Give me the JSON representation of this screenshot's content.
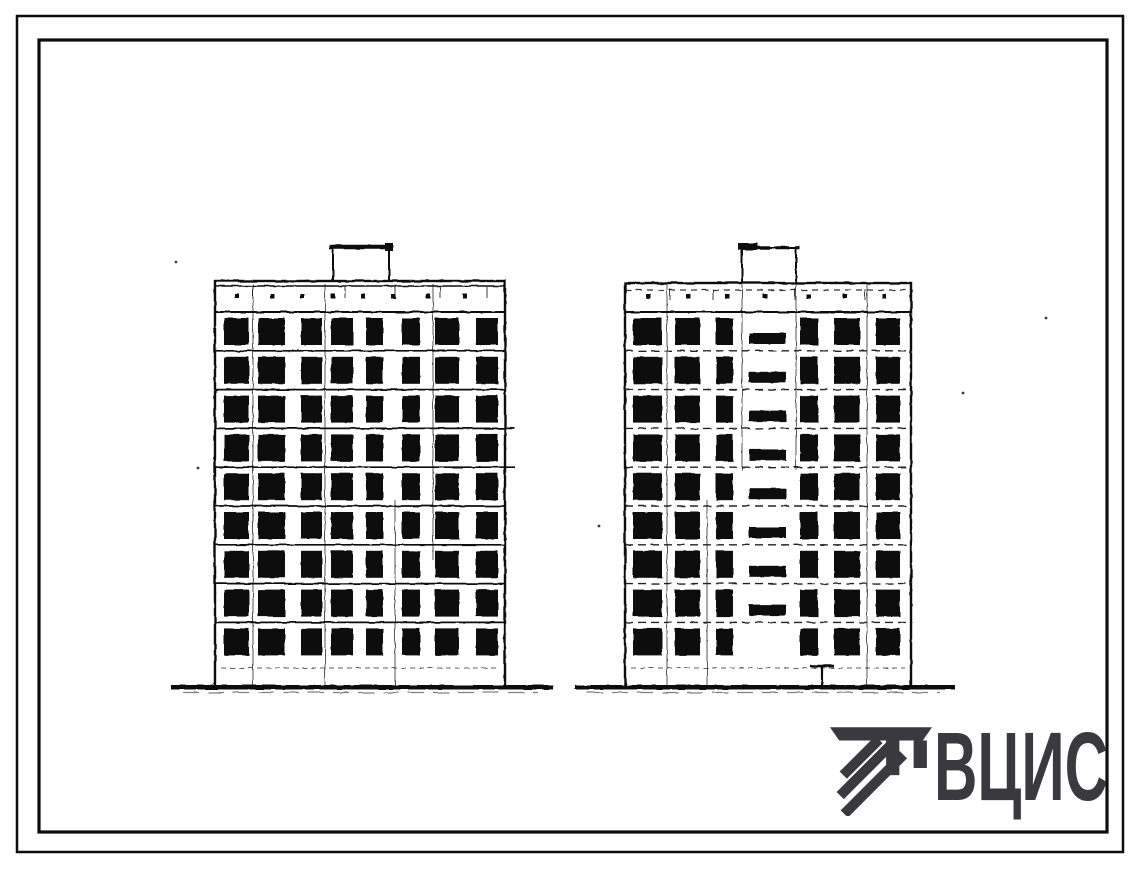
{
  "sheet": {
    "background": "#ffffff",
    "ink": "#0d0d0d",
    "logo_color": "#3a3a3d"
  },
  "frame": {
    "outer": {
      "x": 17,
      "y": 16,
      "w": 1106,
      "h": 836,
      "stroke": 2.5
    },
    "inner": {
      "x": 39,
      "y": 40,
      "w": 1068,
      "h": 792,
      "stroke": 3.2
    }
  },
  "logo": {
    "text": "ВЦИС",
    "icon": "vcis-hatched-column-icon"
  },
  "elevations": [
    {
      "id": "elevation-left",
      "facade": {
        "x": 215,
        "y": 281,
        "w": 290,
        "h": 407
      },
      "parapet": {
        "double_top": true,
        "dots_y": 296,
        "dot_xs": [
          237,
          272,
          302,
          333,
          363,
          393,
          428,
          465
        ],
        "tick_xs": [
          253,
          345,
          395,
          440,
          487
        ]
      },
      "roof_box": {
        "x": 333,
        "y": 247,
        "w": 56,
        "cap_x1": 329,
        "cap_x2": 393,
        "cap_y": 247,
        "cap_style": "solid",
        "blob": "right"
      },
      "floor_lines_y": [
        312,
        350.8,
        389.6,
        428.4,
        467.2,
        506,
        544.8,
        583.6,
        622.4
      ],
      "floor_line_style": "solid",
      "overshoot_lines": [
        3,
        4
      ],
      "window": {
        "top_offset": 6,
        "height": 27
      },
      "window_cols": [
        [
          224,
          25
        ],
        [
          258,
          27
        ],
        [
          301,
          21
        ],
        [
          331,
          22
        ],
        [
          366,
          17
        ],
        [
          402,
          18
        ],
        [
          435,
          24
        ],
        [
          476,
          22
        ]
      ],
      "joints": [
        [
          253,
          284,
          686
        ],
        [
          325,
          284,
          686
        ],
        [
          433,
          284,
          560
        ],
        [
          395,
          500,
          686
        ]
      ],
      "basement_line_y": 668,
      "ground": {
        "x1": 171,
        "x2": 553,
        "y": 685,
        "h": 4.5
      }
    },
    {
      "id": "elevation-right",
      "facade": {
        "x": 625,
        "y": 283,
        "w": 286,
        "h": 405
      },
      "parapet": {
        "top_dashed": true,
        "dots_y": 296,
        "dot_xs": [
          648,
          688,
          727,
          765,
          808,
          845,
          884
        ],
        "tick_xs": [
          670,
          713,
          795,
          865
        ]
      },
      "roof_box": {
        "x": 742,
        "y": 248,
        "w": 54,
        "cap_x1": 738,
        "cap_x2": 800,
        "cap_y": 248,
        "cap_style": "dashed",
        "blob": "left"
      },
      "floor_lines_y": [
        312,
        350.8,
        389.6,
        428.4,
        467.2,
        506,
        544.8,
        583.6,
        622.4
      ],
      "floor_line_style": "dashed",
      "overshoot_lines": [],
      "window": {
        "top_offset": 6,
        "height": 27
      },
      "window_cols": [
        [
          633,
          29
        ],
        [
          675,
          25
        ],
        [
          716,
          17
        ],
        [
          800,
          18
        ],
        [
          834,
          26
        ],
        [
          876,
          24
        ]
      ],
      "stair_slots": {
        "x": 749,
        "w": 37,
        "h": 11,
        "ys": [
          333,
          371.8,
          410.6,
          449.4,
          488.2,
          527,
          565.8,
          604.6
        ]
      },
      "joints": [
        [
          667,
          284,
          686
        ],
        [
          742,
          284,
          470
        ],
        [
          796,
          284,
          470
        ],
        [
          867,
          284,
          686
        ],
        [
          707,
          500,
          686
        ]
      ],
      "entrance": {
        "x": 822,
        "y1": 666,
        "y2": 686,
        "cap_x1": 810,
        "cap_x2": 834
      },
      "basement_line_y": 668,
      "ground": {
        "x1": 575,
        "x2": 955,
        "y": 685,
        "h": 4.5
      }
    }
  ],
  "specks": [
    [
      176,
      262
    ],
    [
      198,
      468
    ],
    [
      963,
      393
    ],
    [
      599,
      526
    ],
    [
      1046,
      318
    ]
  ]
}
